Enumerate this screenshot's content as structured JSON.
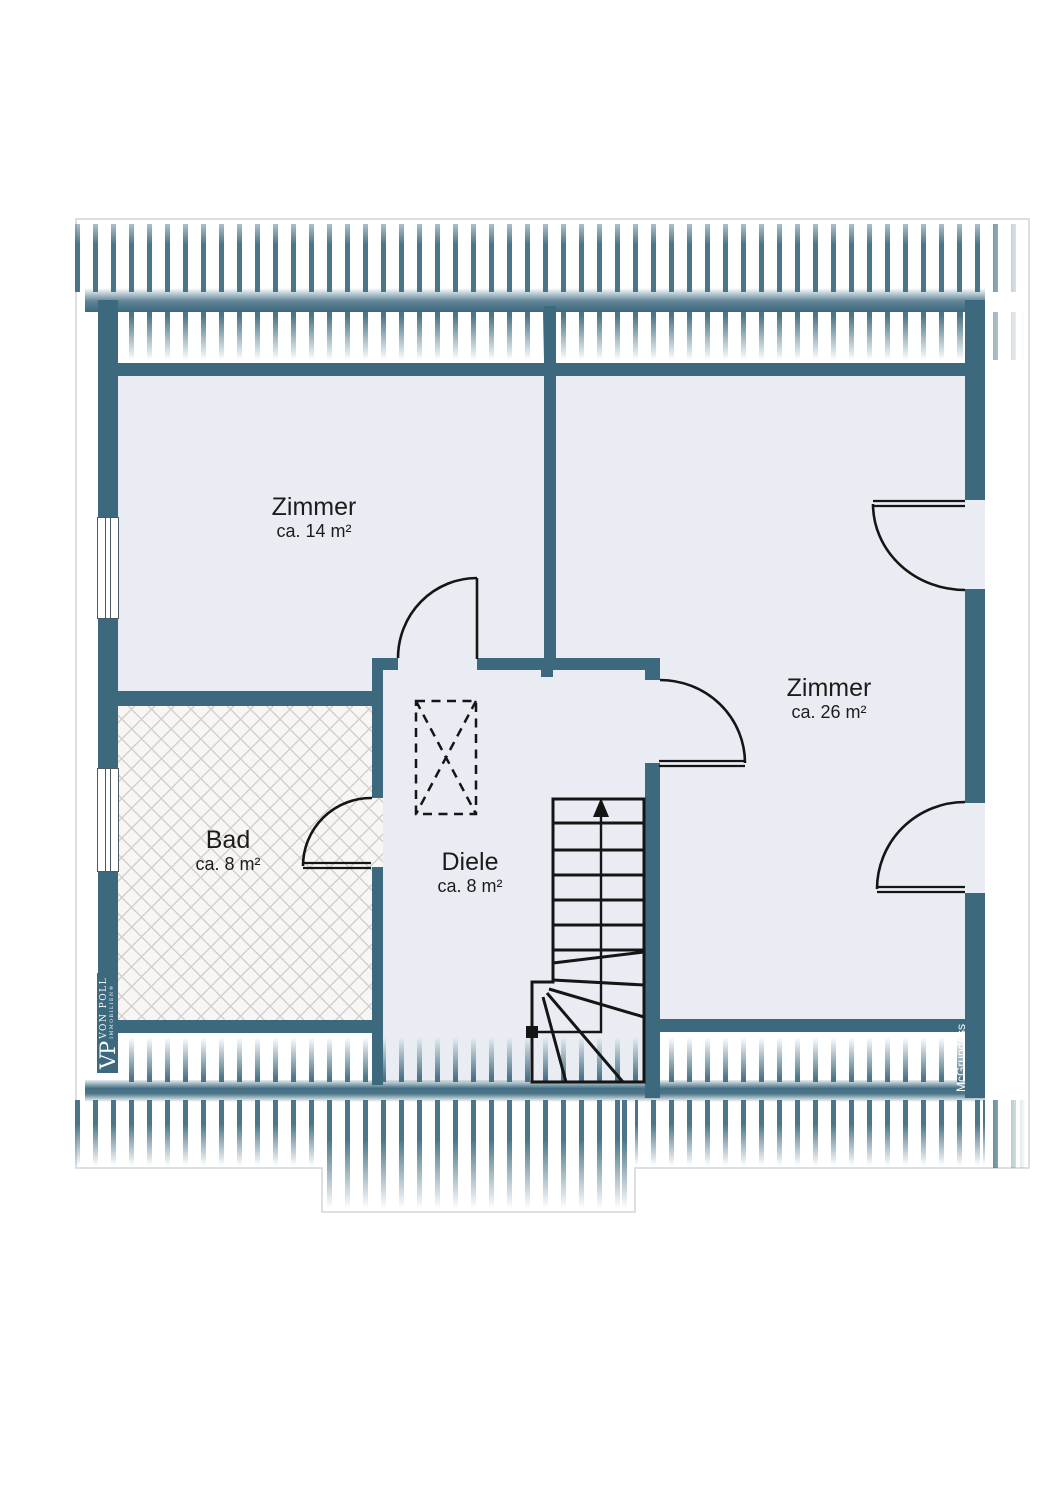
{
  "plan": {
    "type": "attic floor plan",
    "rooms": [
      {
        "name": "Zimmer",
        "area": "ca. 14 m²"
      },
      {
        "name": "Zimmer",
        "area": "ca. 26 m²"
      },
      {
        "name": "Bad",
        "area": "ca. 8 m²"
      },
      {
        "name": "Diele",
        "area": "ca. 8 m²"
      }
    ]
  },
  "branding": {
    "monogram": "VP",
    "brand": "VON POLL",
    "brand_sub": "IMMOBILIEN®",
    "watermark": "McGrundriss"
  },
  "colors": {
    "wall_teal": "#3c697e",
    "room_floor": "#e9edf3",
    "bath_floor": "#f7f6f4",
    "plan_line": "#151515",
    "outline": "#d0d5d8"
  }
}
